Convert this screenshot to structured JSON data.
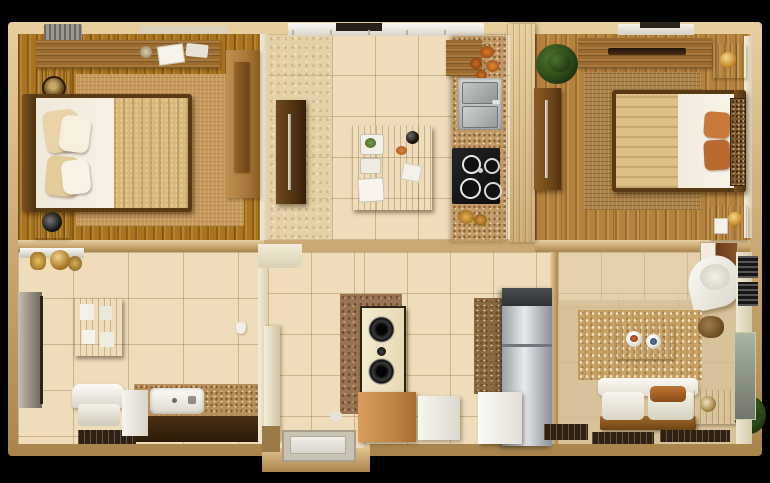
{
  "scene": {
    "description": "Photorealistic 3D top-down floor plan of a two-bedroom apartment, letterboxed on black",
    "view": "top-down render",
    "visible_text": "none"
  },
  "palette": {
    "letterbox": "#000000",
    "wall": "#c9a671",
    "wallLight": "#e7cf9f",
    "innerWall": "#ece2c8",
    "wood1": "#a9741f",
    "wood2": "#b5823d",
    "tile": "#eedcba",
    "mottle": "#e4d1a6",
    "granite": "#c29a66",
    "carpet": "#d8c29a",
    "furnWood": "#9a6428",
    "darkWood": "#5f3c1a",
    "white": "#f4f0e4",
    "blanket1": "#d9b87c",
    "blanket2": "#dcbe86",
    "orange": "#c07434",
    "steel": "#b8bcc0"
  },
  "rooms": [
    {
      "id": "bedroom-1",
      "position": "top-left",
      "floor": "wood planks",
      "furniture": [
        "double bed with beige blanket and pillows",
        "headboard",
        "woven rug",
        "long dresser with clutter",
        "two nightstands",
        "tall wardrobe"
      ]
    },
    {
      "id": "hallway",
      "position": "top-center-left",
      "floor": "mottled tile",
      "furniture": [
        "dark wood cabinet with handle"
      ]
    },
    {
      "id": "kitchen-dining",
      "position": "top-center",
      "floor": "large beige tile",
      "furniture": [
        "dining island with plates and bottle",
        "granite counter",
        "double stainless sink",
        "black cooktop with burners",
        "upper wood cabinet",
        "copper decor",
        "window strip"
      ]
    },
    {
      "id": "bedroom-2",
      "position": "top-right",
      "floor": "wood planks",
      "furniture": [
        "double bed with orange pillows",
        "decorative headboard",
        "rug",
        "top wardrobe",
        "side wardrobe",
        "potted plant",
        "two nightstands with lamps",
        "window"
      ]
    },
    {
      "id": "bathroom",
      "position": "bottom-left",
      "floor": "large beige tile",
      "furniture": [
        "glass mirror panel",
        "wall cabinet",
        "shelf with amber bottles",
        "granite vanity with white sink",
        "toilet",
        "dark mat"
      ]
    },
    {
      "id": "entry",
      "position": "bottom-center-left",
      "floor": "beige tile",
      "furniture": [
        "door mat",
        "white pillar",
        "threshold step"
      ]
    },
    {
      "id": "utility",
      "position": "bottom-center",
      "floor": "beige tile",
      "furniture": [
        "speaker tower with two drivers",
        "orange cabinet",
        "white appliance box",
        "brown shag rug",
        "stainless refrigerator",
        "speckled tall cabinet",
        "white fridge door"
      ]
    },
    {
      "id": "living-room",
      "position": "bottom-right",
      "floor": "beige carpet",
      "furniture": [
        "white sofa with orange cushion",
        "wood coffee table with plates",
        "speckled rug",
        "corner white armchair",
        "wall art",
        "side cabinet",
        "potted plant",
        "AC vent grille",
        "glass wall panel",
        "dark floor mats"
      ]
    }
  ]
}
